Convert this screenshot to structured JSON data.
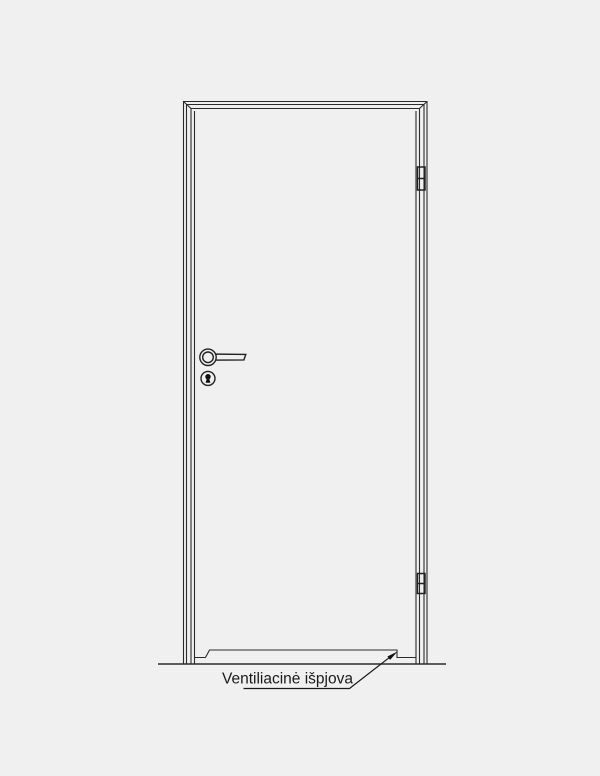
{
  "drawing": {
    "type": "door-elevation-technical-diagram",
    "callout": {
      "label": "Ventiliacinė išpjova",
      "points_to": "ventilation-cutout-bottom-right-corner"
    },
    "components": [
      "door-frame",
      "door-leaf",
      "lever-handle",
      "keyhole-escutcheon",
      "hinge-top",
      "hinge-bottom",
      "ventilation-cutout",
      "floor-line"
    ],
    "hinge_count": 2,
    "colors": {
      "background": "#f0f0f0",
      "line": "#2b2b2b",
      "hardware_line": "#222222",
      "text": "#1a1a1a",
      "keyhole_fill": "#111111"
    }
  }
}
